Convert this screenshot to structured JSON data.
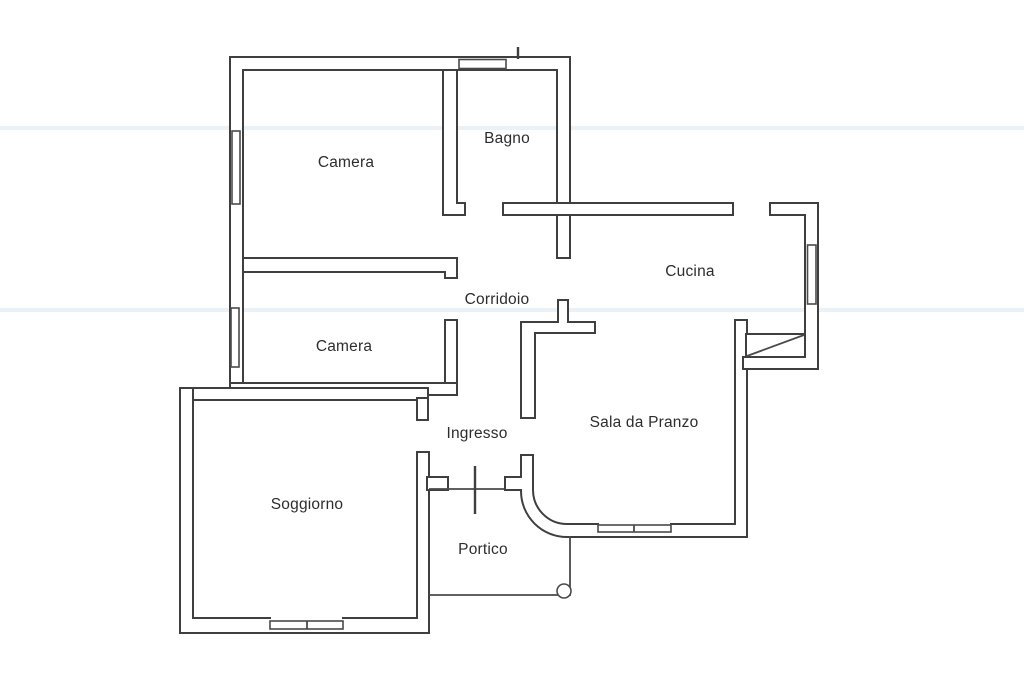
{
  "floor_plan": {
    "type": "apartment-floor-plan",
    "wall_color": "#3f3f3f",
    "background_color": "#ffffff",
    "scan_artifact_color": "#dbe8f1",
    "rooms": [
      {
        "id": "camera-1",
        "label": "Camera"
      },
      {
        "id": "bagno",
        "label": "Bagno"
      },
      {
        "id": "cucina",
        "label": "Cucina"
      },
      {
        "id": "corridoio",
        "label": "Corridoio"
      },
      {
        "id": "camera-2",
        "label": "Camera"
      },
      {
        "id": "ingresso",
        "label": "Ingresso"
      },
      {
        "id": "sala-da-pranzo",
        "label": "Sala da Pranzo"
      },
      {
        "id": "soggiorno",
        "label": "Soggiorno"
      },
      {
        "id": "portico",
        "label": "Portico"
      }
    ],
    "features": {
      "windows": 5,
      "entry_door_marker": "tick line at main entrance near Portico",
      "column": "round pillar at portico corner",
      "curved_wall": "quarter-arc wall between Ingresso and Sala da Pranzo"
    }
  }
}
